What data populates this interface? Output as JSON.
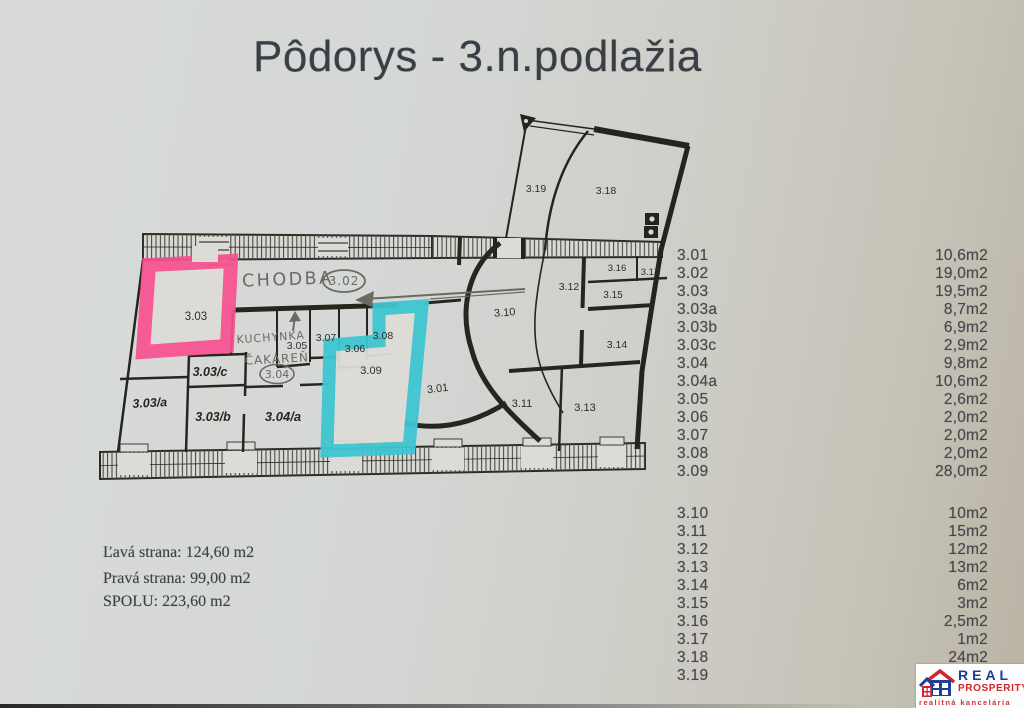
{
  "title": "Pôdorys - 3.n.podlažia",
  "summary": {
    "line1": "Ľavá strana: 124,60 m2",
    "line2": "Pravá strana: 99,00 m2",
    "line3": "SPOLU: 223,60 m2"
  },
  "area_list": {
    "block1": [
      {
        "label": "3.01",
        "value": "10,6m2"
      },
      {
        "label": "3.02",
        "value": "19,0m2"
      },
      {
        "label": "3.03",
        "value": "19,5m2"
      },
      {
        "label": "3.03a",
        "value": "8,7m2"
      },
      {
        "label": "3.03b",
        "value": "6,9m2"
      },
      {
        "label": "3.03c",
        "value": "2,9m2"
      },
      {
        "label": "3.04",
        "value": "9,8m2"
      },
      {
        "label": "3.04a",
        "value": "10,6m2"
      },
      {
        "label": "3.05",
        "value": "2,6m2"
      },
      {
        "label": "3.06",
        "value": "2,0m2"
      },
      {
        "label": "3.07",
        "value": "2,0m2"
      },
      {
        "label": "3.08",
        "value": "2,0m2"
      },
      {
        "label": "3.09",
        "value": "28,0m2"
      }
    ],
    "block2": [
      {
        "label": "3.10",
        "value": "10m2"
      },
      {
        "label": "3.11",
        "value": "15m2"
      },
      {
        "label": "3.12",
        "value": "12m2"
      },
      {
        "label": "3.13",
        "value": "13m2"
      },
      {
        "label": "3.14",
        "value": "6m2"
      },
      {
        "label": "3.15",
        "value": "3m2"
      },
      {
        "label": "3.16",
        "value": "2,5m2"
      },
      {
        "label": "3.17",
        "value": "1m2"
      },
      {
        "label": "3.18",
        "value": "24m2"
      },
      {
        "label": "3.19",
        "value": ""
      }
    ]
  },
  "plan": {
    "highlights": {
      "room_303_border": "#f8518f",
      "room_309_border": "#3fc6d1"
    },
    "labels": [
      {
        "t": "3.19",
        "x": 536,
        "y": 192,
        "cls": "p",
        "fs": 10.5
      },
      {
        "t": "3.18",
        "x": 606,
        "y": 194,
        "cls": "p",
        "fs": 10.5
      },
      {
        "t": "3.03",
        "x": 196,
        "y": 320,
        "cls": "p",
        "fs": 11.5
      },
      {
        "t": "CHODBA",
        "x": 288,
        "y": 285,
        "cls": "h",
        "fs": 17.5,
        "ls": 2.5,
        "r": -2
      },
      {
        "t": "3.02",
        "x": 344,
        "y": 285,
        "cls": "h",
        "fs": 12,
        "ls": 1
      },
      {
        "t": "3.05",
        "x": 297,
        "y": 349,
        "cls": "p",
        "fs": 10.5
      },
      {
        "t": "3.07",
        "x": 326,
        "y": 341,
        "cls": "p",
        "fs": 10.5
      },
      {
        "t": "3.06",
        "x": 355,
        "y": 352,
        "cls": "p",
        "fs": 10.5
      },
      {
        "t": "3.08",
        "x": 383,
        "y": 339,
        "cls": "p",
        "fs": 10.5
      },
      {
        "t": "KUCHYNKA",
        "x": 271,
        "y": 341,
        "cls": "h",
        "fs": 11,
        "ls": 1,
        "r": -4
      },
      {
        "t": "ČAKÁREŇ",
        "x": 277,
        "y": 363,
        "cls": "h",
        "fs": 12,
        "ls": 1,
        "r": -3
      },
      {
        "t": "3.04",
        "x": 277,
        "y": 378,
        "cls": "h",
        "fs": 11
      },
      {
        "t": "3.03/c",
        "x": 210,
        "y": 376,
        "cls": "s",
        "fs": 12.5
      },
      {
        "t": "3.03/a",
        "x": 150,
        "y": 407,
        "cls": "s",
        "fs": 12.5,
        "r": -3
      },
      {
        "t": "3.03/b",
        "x": 213,
        "y": 421,
        "cls": "s",
        "fs": 12.5
      },
      {
        "t": "3.04/a",
        "x": 283,
        "y": 421,
        "cls": "s",
        "fs": 13
      },
      {
        "t": "3.09",
        "x": 371,
        "y": 374,
        "cls": "p",
        "fs": 11
      },
      {
        "t": "3.01",
        "x": 438,
        "y": 392,
        "cls": "p",
        "fs": 11,
        "r": -7
      },
      {
        "t": "3.10",
        "x": 505,
        "y": 316,
        "cls": "p",
        "fs": 11,
        "r": -4
      },
      {
        "t": "3.12",
        "x": 569,
        "y": 290,
        "cls": "p",
        "fs": 10.5
      },
      {
        "t": "3.16",
        "x": 617,
        "y": 271,
        "cls": "p",
        "fs": 9.5
      },
      {
        "t": "3.17",
        "x": 650,
        "y": 275,
        "cls": "p",
        "fs": 9.5
      },
      {
        "t": "3.15",
        "x": 613,
        "y": 298,
        "cls": "p",
        "fs": 10
      },
      {
        "t": "3.14",
        "x": 617,
        "y": 348,
        "cls": "p",
        "fs": 10.5
      },
      {
        "t": "3.11",
        "x": 522,
        "y": 407,
        "cls": "p",
        "fs": 11
      },
      {
        "t": "3.13",
        "x": 585,
        "y": 411,
        "cls": "p",
        "fs": 11
      }
    ]
  },
  "logo": {
    "line1": "REAL",
    "line2": "PROSPERITY",
    "line3": "realitná kancelária"
  }
}
